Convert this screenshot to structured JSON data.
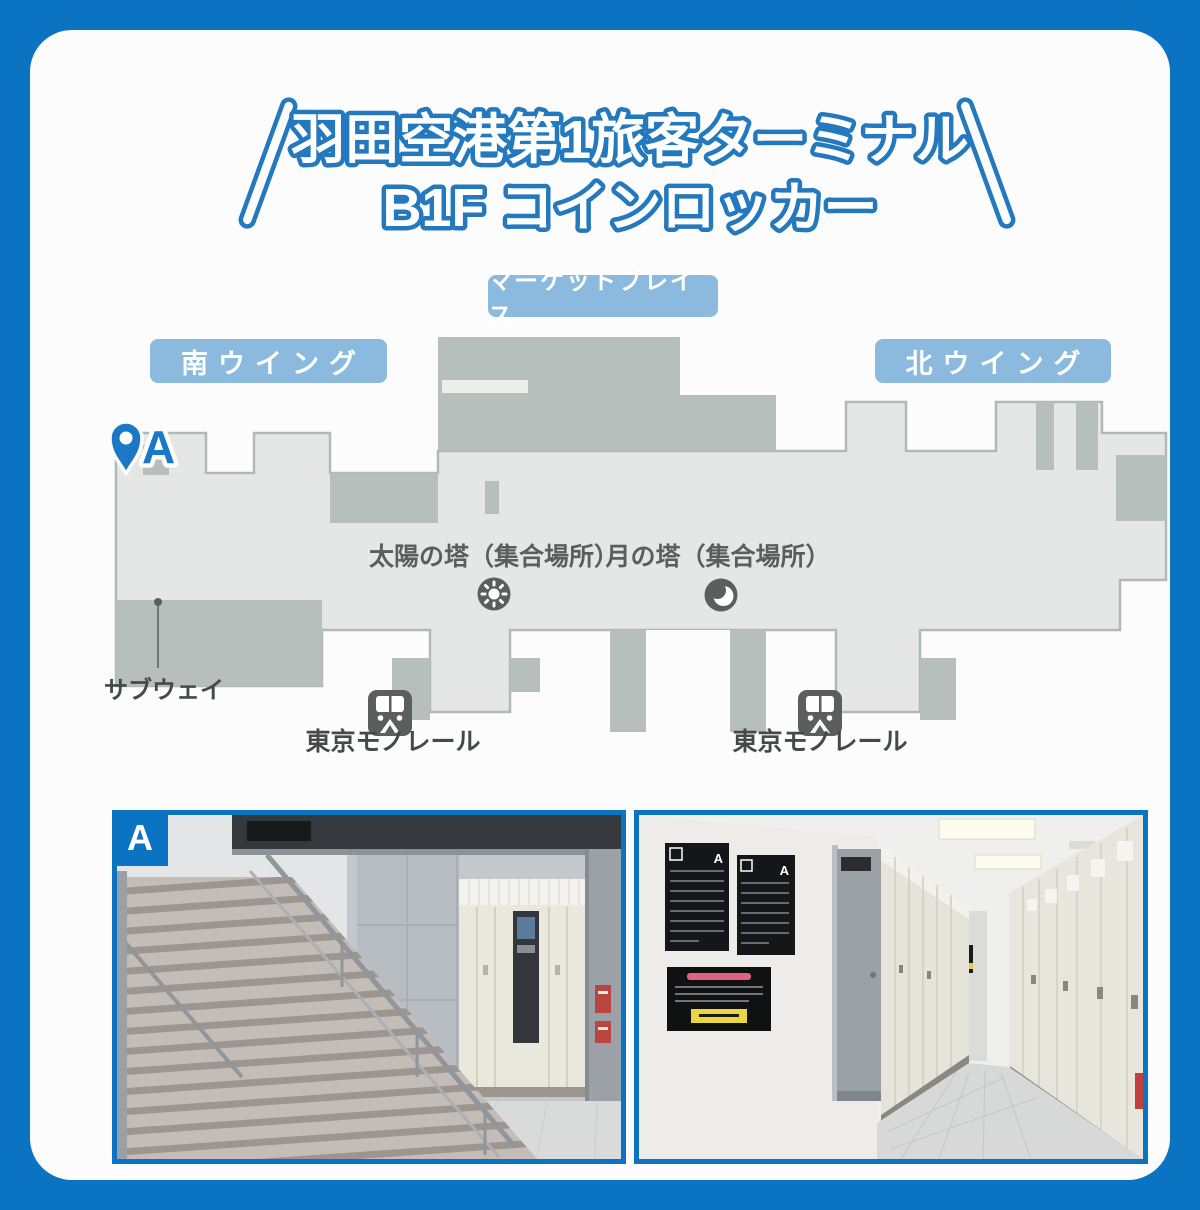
{
  "title": {
    "line1": "羽田空港第1旅客ターミナル",
    "line2": "B1F コインロッカー"
  },
  "map": {
    "marketplace_label": "マーケットプレイス",
    "south_wing_label": "南ウイング",
    "north_wing_label": "北ウイング",
    "marker_a_label": "A",
    "sun_tower_label": "太陽の塔（集合場所）",
    "moon_tower_label": "月の塔（集合場所）",
    "subway_label": "サブウェイ",
    "monorail_left_label": "東京モノレール",
    "monorail_right_label": "東京モノレール"
  },
  "photos": {
    "location_badge": "A",
    "poster_badge": "A"
  },
  "colors": {
    "frame_blue": "#0a73c2",
    "pill_blue": "#8cbade",
    "title_outline_blue": "#2478bd",
    "pin_blue": "#1a78c6",
    "map_floor": "#e4e7e5",
    "map_floor_stroke": "#b1b9b7",
    "map_block_gray": "#b7bfbd",
    "icon_dark_gray": "#5a5f5e",
    "card_bg": "#fbfcfb"
  }
}
